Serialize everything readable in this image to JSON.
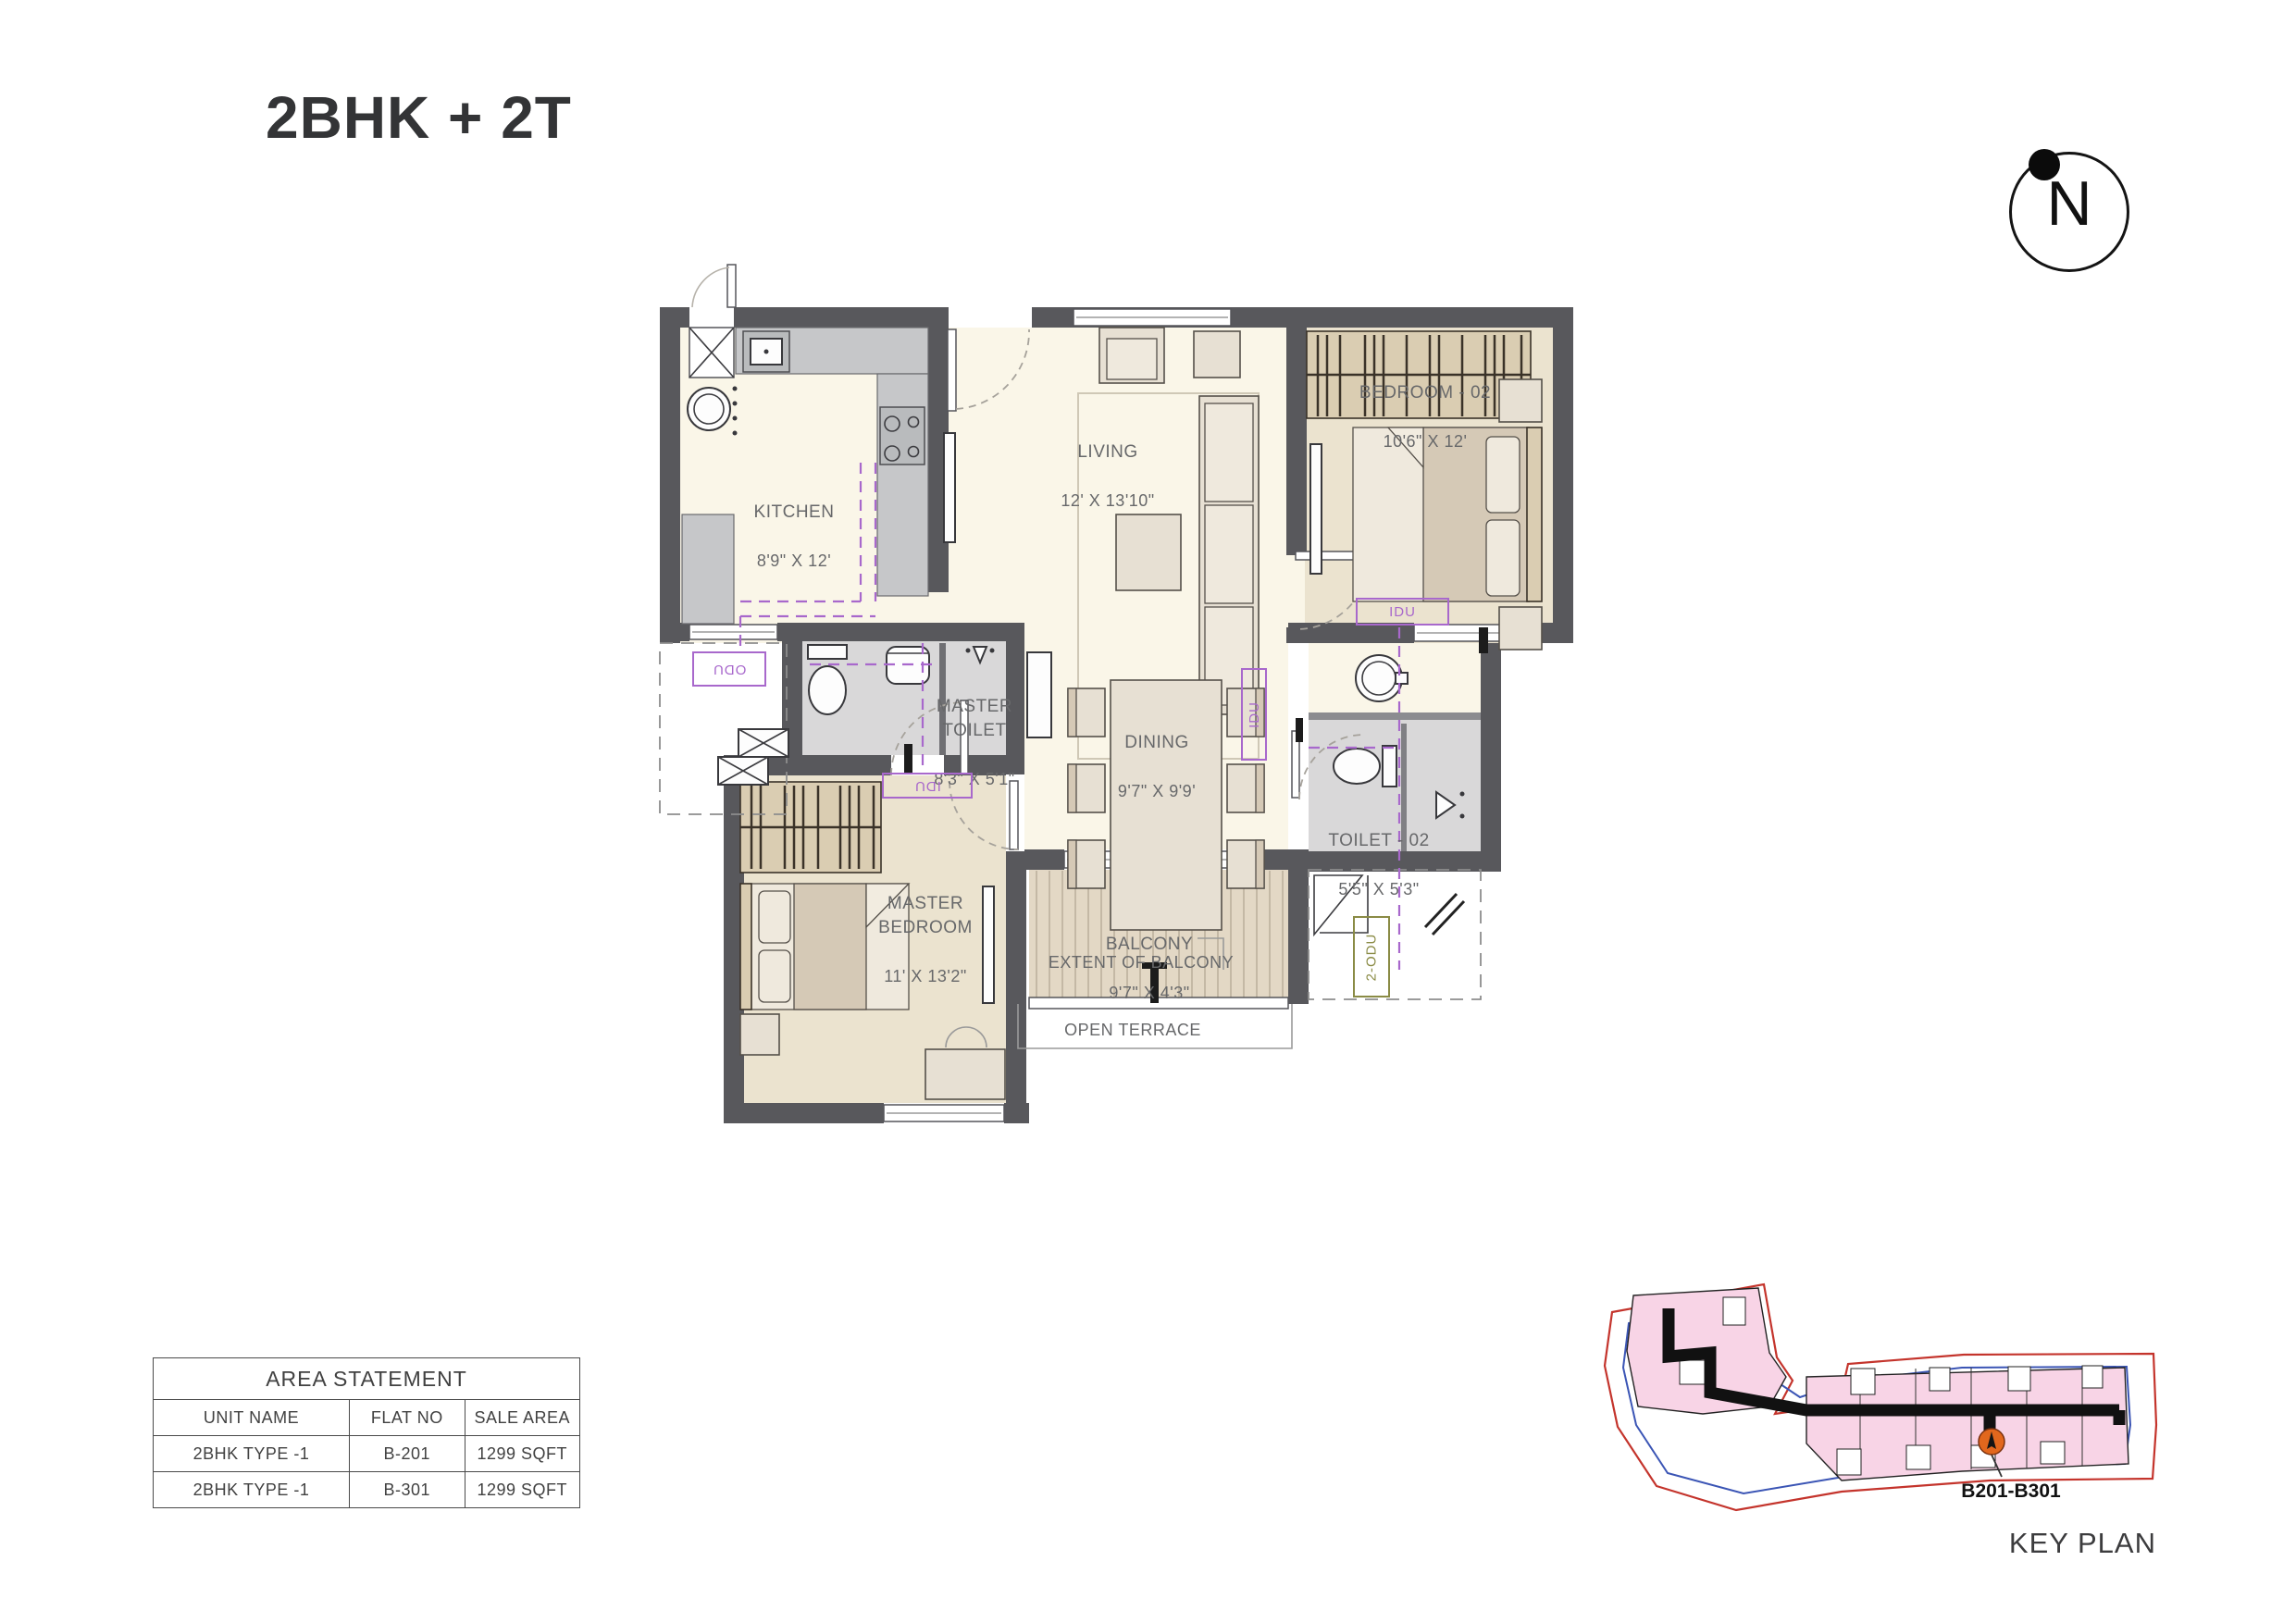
{
  "title": "2BHK + 2T",
  "compass": {
    "letter": "N"
  },
  "plan": {
    "rooms": [
      {
        "id": "kitchen",
        "name": "KITCHEN",
        "dims": "8'9\" X 12'"
      },
      {
        "id": "living",
        "name": "LIVING",
        "dims": "12' X 13'10\""
      },
      {
        "id": "bedroom-02",
        "name": "BEDROOM - 02",
        "dims": "10'6\" X 12'"
      },
      {
        "id": "master-toilet",
        "name": "MASTER TOILET",
        "dims": "8'3\" X 5'1\""
      },
      {
        "id": "dining",
        "name": "DINING",
        "dims": "9'7\" X 9'9'"
      },
      {
        "id": "master-bedroom",
        "name": "MASTER BEDROOM",
        "dims": "11' X 13'2\""
      },
      {
        "id": "toilet-02",
        "name": "TOILET - 02",
        "dims": "5'5\" X 5'3\""
      },
      {
        "id": "balcony",
        "name": "BALCONY",
        "dims": "9'7\" X 4'3\""
      }
    ],
    "annotations": {
      "extent_of_balcony": "EXTENT OF BALCONY",
      "open_terrace": "OPEN TERRACE",
      "idu": "IDU",
      "odu": "ODU",
      "two_odu": "2-ODU"
    }
  },
  "area_statement": {
    "title": "AREA STATEMENT",
    "columns": [
      "UNIT NAME",
      "FLAT NO",
      "SALE AREA"
    ],
    "rows": [
      [
        "2BHK  TYPE -1",
        "B-201",
        "1299 SQFT"
      ],
      [
        "2BHK  TYPE -1",
        "B-301",
        "1299 SQFT"
      ]
    ]
  },
  "key_plan": {
    "label": "KEY PLAN",
    "marker_label": "B201-B301"
  },
  "colors": {
    "wall": "#58585c",
    "floor_cream": "#faf6e8",
    "floor_beige": "#ebe3cf",
    "floor_gray": "#d9d8d9",
    "counter": "#c6c7c9",
    "furniture": "#e7e0d3",
    "furniture_dark": "#d5c9b6",
    "wood": "#dacdb2",
    "wood_stroke": "#3a3228",
    "deck": "#e3d8c5",
    "deck_line": "#bcb19d",
    "purple": "#a868cc",
    "olive": "#8a8b45",
    "kp_pink": "#f8d4e6",
    "kp_red": "#c4342c",
    "kp_blue": "#3b55b5",
    "kp_orange": "#e2671d"
  }
}
